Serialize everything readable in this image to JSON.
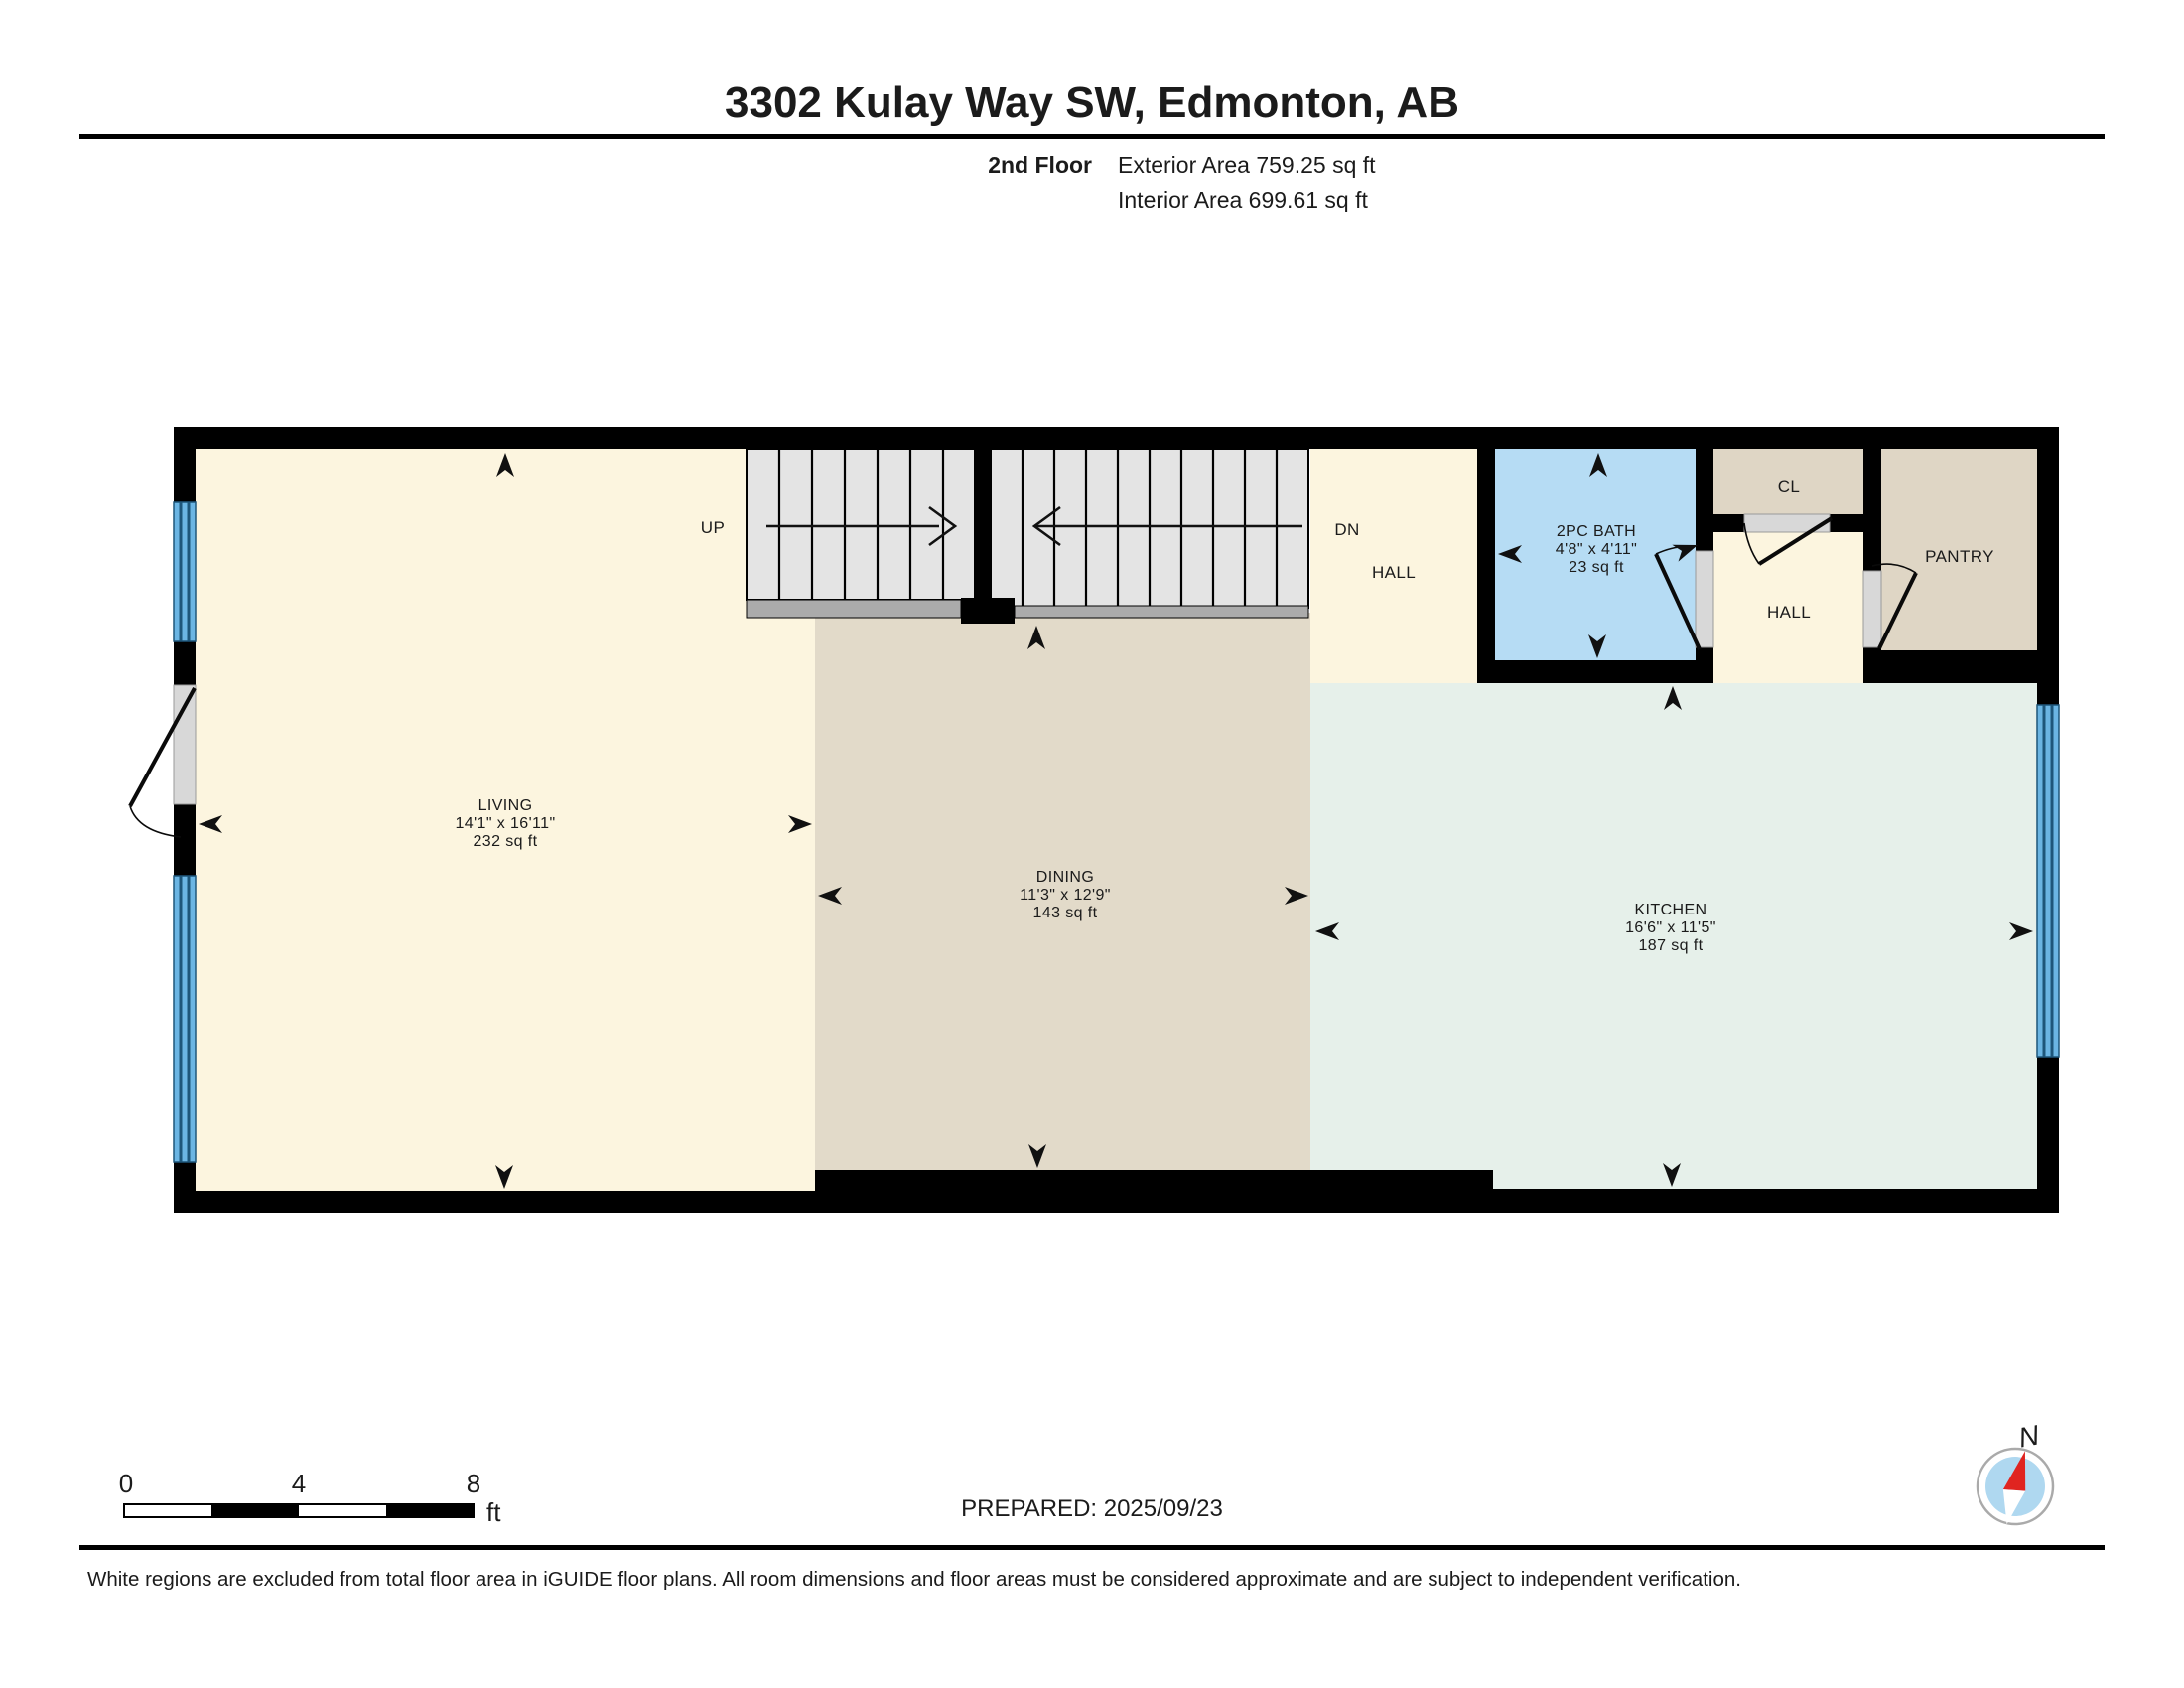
{
  "header": {
    "title": "3302 Kulay Way SW, Edmonton, AB",
    "floor_label": "2nd Floor",
    "exterior_area": "Exterior Area 759.25 sq ft",
    "interior_area": "Interior Area 699.61 sq ft"
  },
  "rooms": {
    "living": {
      "name": "LIVING",
      "dims": "14'1\" x 16'11\"",
      "area": "232 sq ft"
    },
    "dining": {
      "name": "DINING",
      "dims": "11'3\" x 12'9\"",
      "area": "143 sq ft"
    },
    "kitchen": {
      "name": "KITCHEN",
      "dims": "16'6\" x 11'5\"",
      "area": "187 sq ft"
    },
    "bath": {
      "name": "2PC BATH",
      "dims": "4'8\" x 4'11\"",
      "area": "23 sq ft"
    },
    "hall_upper": {
      "name": "HALL"
    },
    "hall_right": {
      "name": "HALL"
    },
    "closet": {
      "name": "CL"
    },
    "pantry": {
      "name": "PANTRY"
    }
  },
  "stairs": {
    "up": "UP",
    "down": "DN"
  },
  "scale_bar": {
    "labels": [
      "0",
      "4",
      "8"
    ],
    "unit": "ft"
  },
  "compass": {
    "label": "N"
  },
  "footer": {
    "prepared": "PREPARED: 2025/09/23",
    "disclaimer": "White regions are excluded from total floor area in iGUIDE floor plans. All room dimensions and floor areas must be considered approximate and are subject to independent verification."
  },
  "colors": {
    "wall": "#000000",
    "living": "#FCF5DF",
    "dining": "#E2DAC9",
    "kitchen": "#E6F0EA",
    "bath": "#B6DCF4",
    "closet": "#DFD6C5",
    "pantry": "#DFD6C5",
    "window": "#6BB5E3",
    "window_frame": "#1E567A",
    "stair": "#E4E4E4",
    "landing": "#ABABAB",
    "door": "#D8D8D8",
    "compass_face": "#AFD8F0",
    "compass_needle": "#E02420"
  }
}
